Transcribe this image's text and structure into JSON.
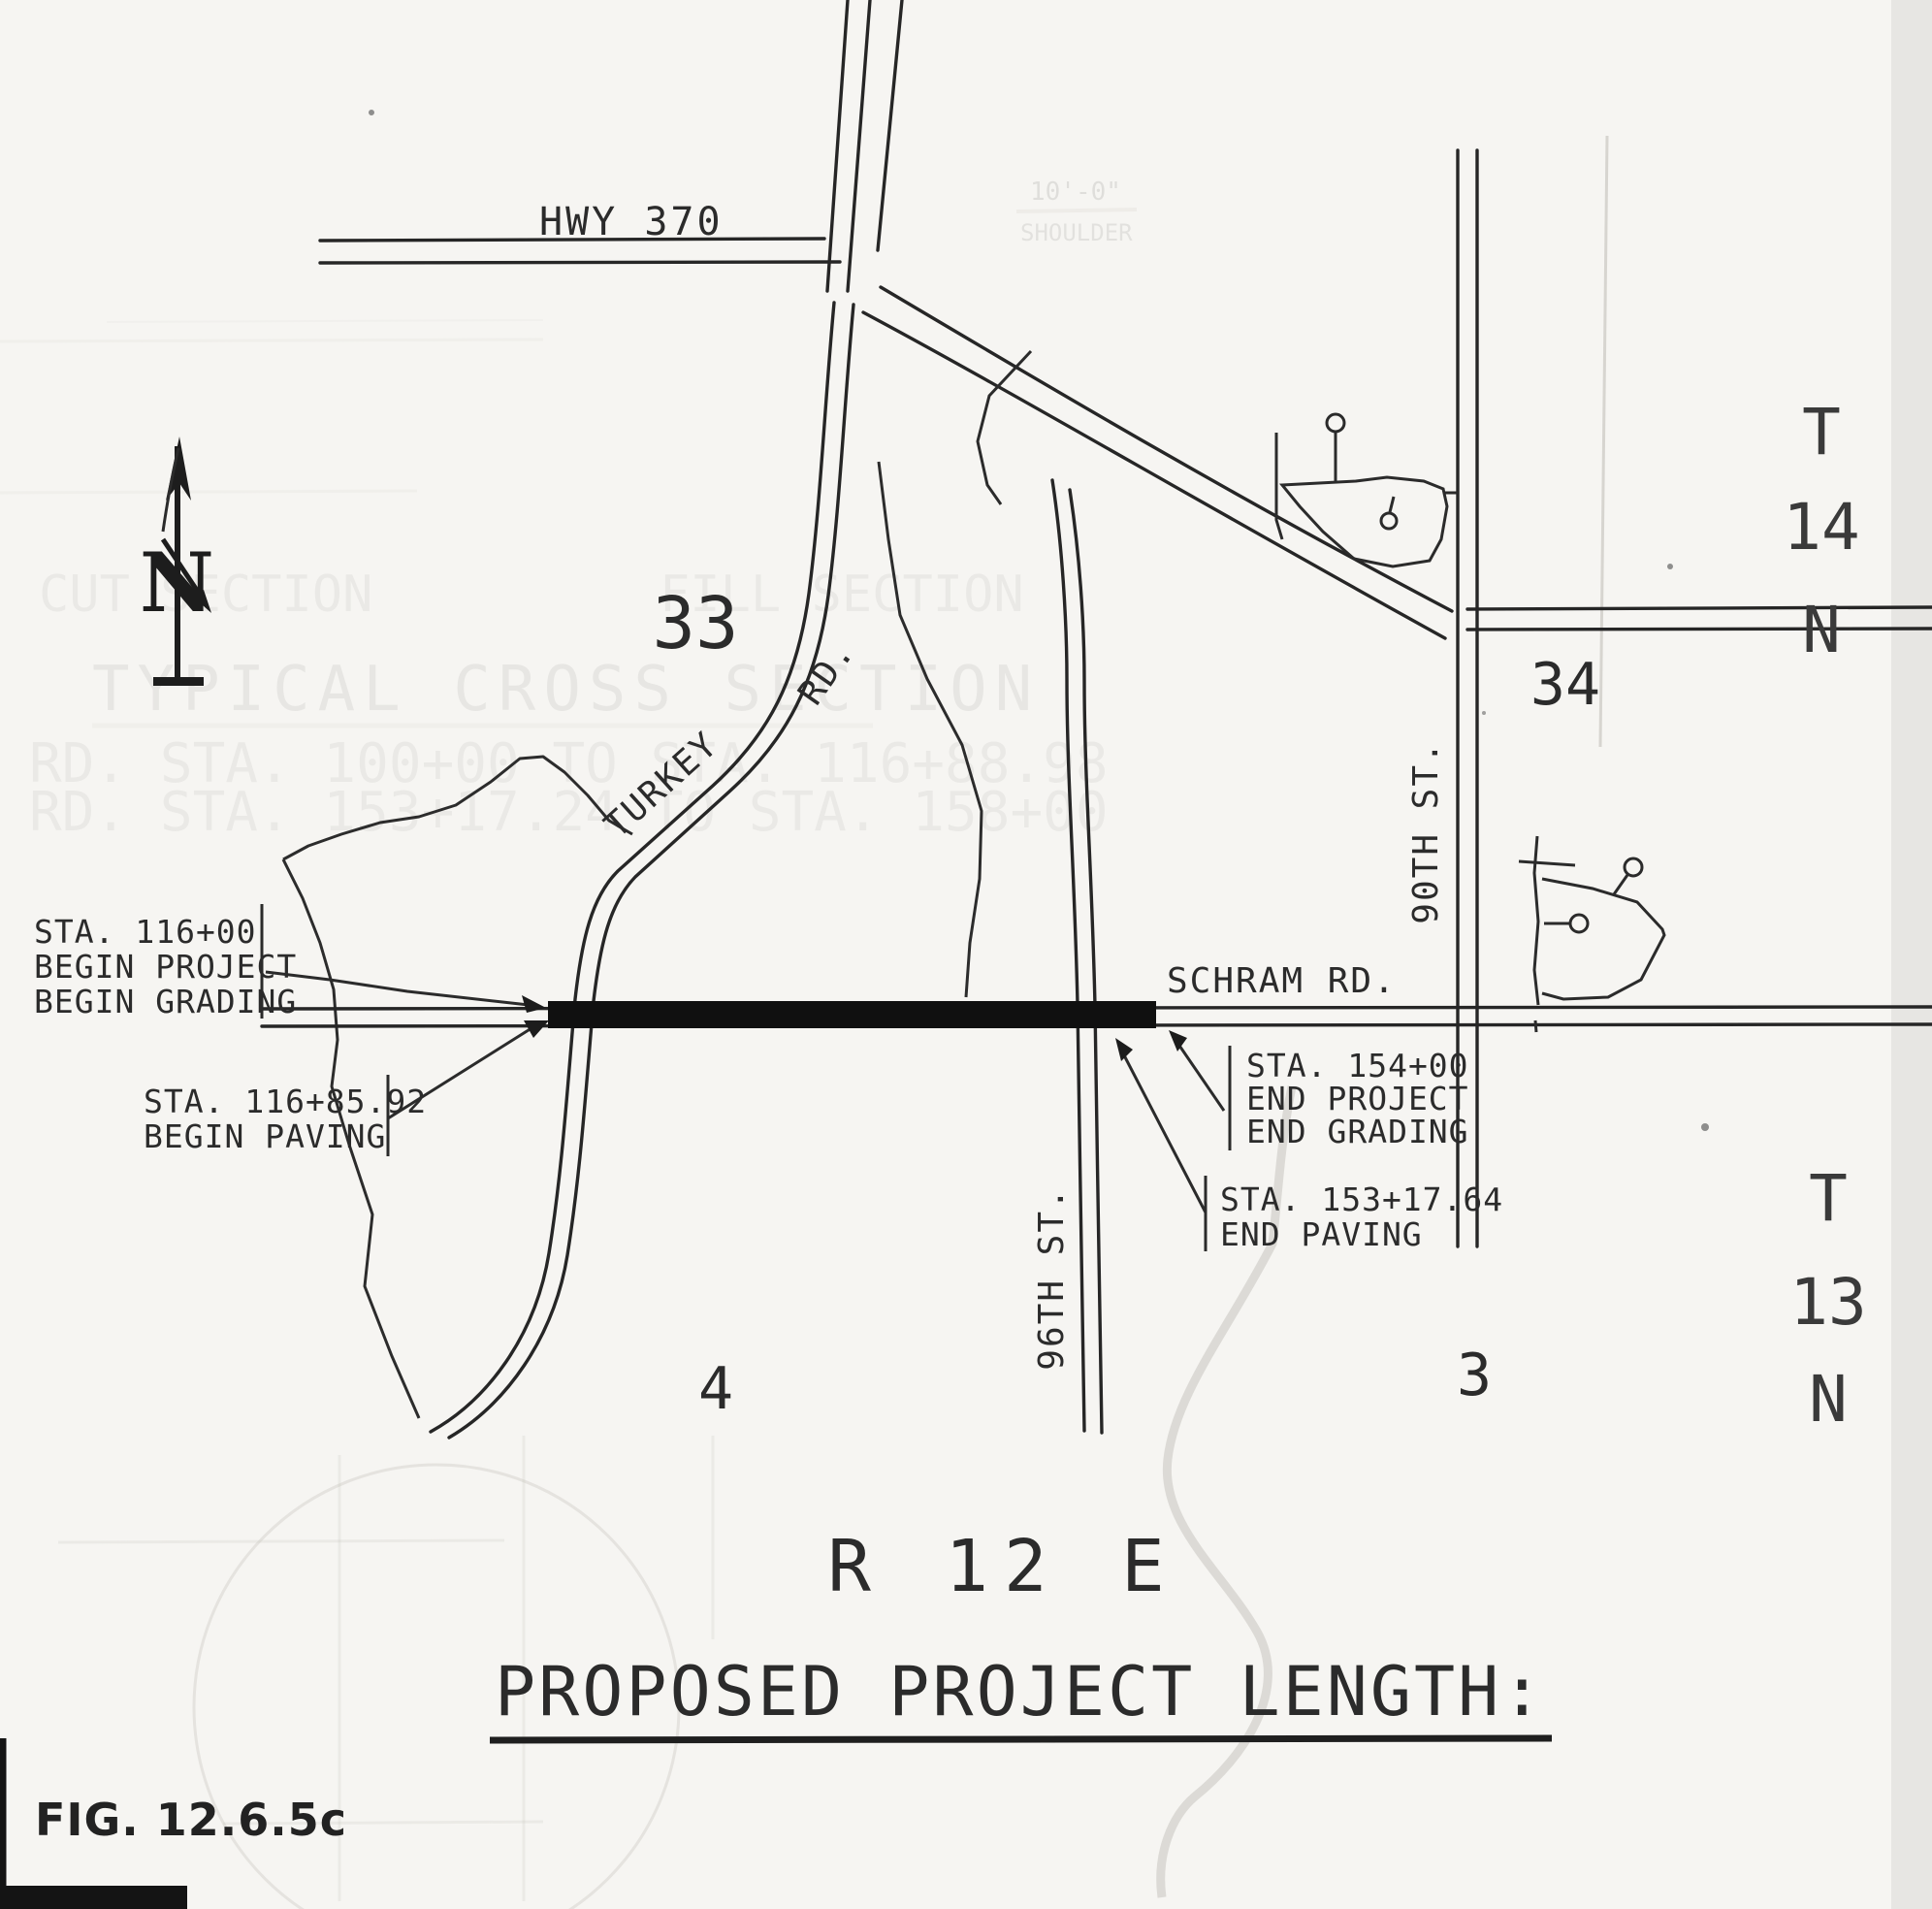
{
  "figure": {
    "number": "FIG. 12.6.5c"
  },
  "title": {
    "range": "R 12 E",
    "caption": "PROPOSED PROJECT LENGTH:"
  },
  "north": {
    "label": "N"
  },
  "map": {
    "roads": {
      "hwy": "HWY 370",
      "turkey_part1": "TURKEY",
      "turkey_part2": "RD.",
      "schram": "SCHRAM RD.",
      "st90": "90TH ST.",
      "st96": "96TH ST."
    },
    "sections": {
      "s33": "33",
      "s34": "34",
      "s4": "4",
      "s3": "3"
    },
    "t14": {
      "t": "T",
      "num": "14",
      "n": "N"
    },
    "t13": {
      "t": "T",
      "num": "13",
      "n": "N"
    },
    "callouts": {
      "begin_project": {
        "line1": "STA. 116+00",
        "line2": "BEGIN PROJECT",
        "line3": "BEGIN GRADING"
      },
      "begin_paving": {
        "line1": "STA. 116+85.92",
        "line2": "BEGIN PAVING"
      },
      "end_project": {
        "line1": "STA. 154+00",
        "line2": "END PROJECT",
        "line3": "END GRADING"
      },
      "end_paving": {
        "line1": "STA. 153+17.64",
        "line2": "END PAVING"
      }
    },
    "bleed_through": {
      "row1a": "CUT SECTION",
      "row1b": "FILL SECTION",
      "row2": "TYPICAL CROSS SECTION",
      "row3": "RD. STA. 100+00 TO STA. 116+88.98",
      "row4": "RD. STA. 153+17.24 TO STA. 158+00",
      "corner1": "10'-0\"",
      "corner2": "SHOULDER"
    }
  },
  "colors": {
    "ink": "#2b2b2b",
    "paper": "#f6f5f2",
    "project_bar": "#101010"
  }
}
